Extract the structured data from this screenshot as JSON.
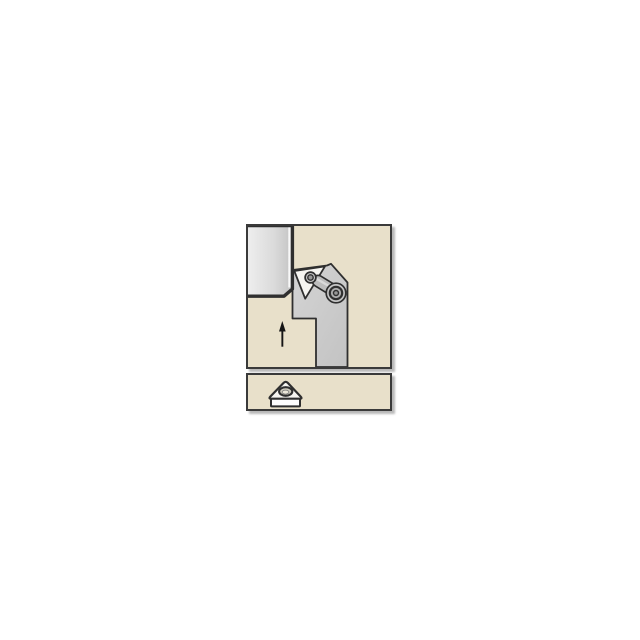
{
  "illustration": {
    "description": "Lathe turning tool holder with lever-clamped triangular insert machining the corner of a rectangular workpiece; upward feed-direction arrow; separate panel below shows the triangular insert with center hole",
    "text_content": "none"
  },
  "colors": {
    "page_bg": "#ffffff",
    "panel_bg": "#e8e0ca",
    "panel_border": "#3a3a3a",
    "outline": "#2f2f2f",
    "ink": "#151515",
    "tool_light": "#d4d4d4",
    "tool_dark": "#c3c3c3",
    "work_light": "#efefef",
    "work_mid": "#dadada",
    "work_dark": "#c1c1c1",
    "work_highlight": "#f8f8f8",
    "metal_cap": "#c6c6c6",
    "metal_ring": "#aeaeae",
    "metal_core": "#989898",
    "clamp_fill": "#bdbdbd",
    "clamp_highlight": "#dadada",
    "insert_fill": "#f6f5f1",
    "face_fill": "#fdfdfd",
    "hole_ring": "#cfccbe",
    "hole_inner": "#ece8da",
    "shadow": "rgba(0,0,0,0.28)"
  },
  "icons": {
    "feed_arrow": "feed-direction-arrow",
    "insert_screw": "insert-screw",
    "clamp_screw": "clamp-screw",
    "clamp_lever": "clamp-lever",
    "triangular_insert": "triangular-insert-with-hole"
  }
}
